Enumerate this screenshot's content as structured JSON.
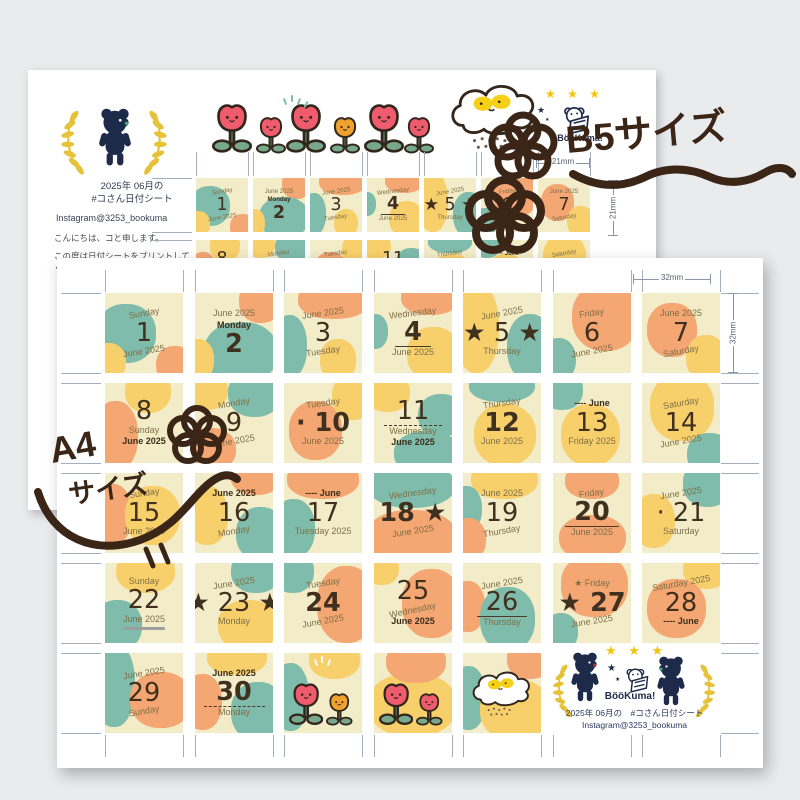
{
  "colors": {
    "background": "#eaebed",
    "sheet": "#ffffff",
    "teal": "#7fbcab",
    "yellow": "#f8d06b",
    "cream": "#f3ecc8",
    "orange": "#f4a673",
    "navy": "#1e2a4a",
    "star_yellow": "#f2c40f",
    "tulip_pink": "#ef5c6e",
    "tulip_orange": "#f0a22e",
    "leaf_green": "#79a98c",
    "laurel_yellow": "#e5c238",
    "handwriting_brown": "#3a2517",
    "text_dark": "#40301f",
    "text_olive": "#7d6f46",
    "tick_gray": "#a3aebe"
  },
  "b5_sheet": {
    "title_line1": "2025年 06月の",
    "title_line2": "#コさん日付シート",
    "instagram": "Instagram@3253_bookuma",
    "greeting": "こんにちは、コと申します。",
    "message_line1": "この度は日付シートをプリントして",
    "message_line2": "くださりありがとうございます。",
    "brand": "BööKuma!",
    "cell_size_label_h": "21mm",
    "cell_size_label_v": "21mm"
  },
  "a4_sheet": {
    "cell_size_label_h": "32mm",
    "cell_size_label_v": "32mm",
    "footer": {
      "brand": "BööKuma!",
      "line1": "2025年 06月の　#コさん日付シート",
      "line2": "Instagram@3253_bookuma"
    }
  },
  "annotations": {
    "b5_size_label": "B5サイズ",
    "a4_size_label_line1": "A4",
    "a4_size_label_line2": "サイズ"
  },
  "calendar": {
    "month": "June",
    "year": "2025",
    "cells": [
      {
        "n": 1,
        "lines": [
          {
            "t": "Sunday",
            "c": "m",
            "r": -10
          },
          {
            "t": "1",
            "c": "n"
          },
          {
            "t": "June 2025",
            "c": "m",
            "r": -9
          }
        ],
        "bl": [
          [
            "t",
            -12,
            14,
            78,
            74
          ],
          [
            "y",
            -18,
            62,
            45,
            48
          ],
          [
            "o",
            66,
            66,
            48,
            48
          ]
        ]
      },
      {
        "n": 2,
        "lines": [
          {
            "t": "June 2025",
            "c": "m"
          },
          {
            "t": "Monday",
            "c": "mb"
          },
          {
            "t": "2",
            "c": "nb"
          }
        ],
        "bl": [
          [
            "o",
            56,
            -16,
            56,
            54
          ],
          [
            "t",
            12,
            36,
            95,
            76
          ],
          [
            "y",
            -16,
            58,
            40,
            52
          ]
        ]
      },
      {
        "n": 3,
        "lines": [
          {
            "t": "June 2025",
            "c": "m",
            "r": -8
          },
          {
            "t": "3",
            "c": "n"
          },
          {
            "t": "Tuesday",
            "c": "m",
            "r": -8
          }
        ],
        "bl": [
          [
            "o",
            18,
            -16,
            92,
            48
          ],
          [
            "t",
            -16,
            28,
            46,
            78
          ],
          [
            "y",
            46,
            58,
            46,
            52
          ]
        ]
      },
      {
        "n": 4,
        "lines": [
          {
            "t": "Wednesday",
            "c": "m",
            "r": -7
          },
          {
            "t": "4",
            "c": "nb",
            "u": 1
          },
          {
            "t": "June 2025",
            "c": "m"
          }
        ],
        "bl": [
          [
            "o",
            34,
            -16,
            76,
            44
          ],
          [
            "t",
            -16,
            26,
            34,
            44
          ],
          [
            "y",
            42,
            42,
            68,
            68
          ]
        ]
      },
      {
        "n": 5,
        "lines": [
          {
            "t": "June 2025",
            "c": "m",
            "r": -10
          },
          {
            "t": "★ 5 ★",
            "c": "n"
          },
          {
            "t": "Thursday",
            "c": "m"
          }
        ],
        "bl": [
          [
            "y",
            -12,
            -12,
            58,
            112
          ],
          [
            "t",
            56,
            26,
            60,
            84
          ]
        ]
      },
      {
        "n": 6,
        "lines": [
          {
            "t": "Friday",
            "c": "m",
            "r": -8
          },
          {
            "t": "6",
            "c": "n"
          },
          {
            "t": "June 2025",
            "c": "m",
            "r": -10
          }
        ],
        "bl": [
          [
            "o",
            24,
            -12,
            86,
            84
          ],
          [
            "t",
            -16,
            56,
            46,
            54
          ]
        ]
      },
      {
        "n": 7,
        "lines": [
          {
            "t": "June 2025",
            "c": "m"
          },
          {
            "t": "7",
            "c": "n"
          },
          {
            "t": "Saturday",
            "c": "m",
            "r": -10
          }
        ],
        "bl": [
          [
            "o",
            6,
            12,
            64,
            68
          ],
          [
            "y",
            56,
            52,
            52,
            58
          ]
        ]
      },
      {
        "n": 8,
        "lines": [
          {
            "t": "8",
            "c": "n"
          },
          {
            "t": "Sunday",
            "c": "m"
          },
          {
            "t": "June 2025",
            "c": "mb"
          }
        ],
        "bl": [
          [
            "y",
            26,
            -16,
            58,
            54
          ],
          [
            "o",
            -16,
            22,
            58,
            88
          ]
        ]
      },
      {
        "n": 9,
        "lines": [
          {
            "t": "Monday",
            "c": "m",
            "r": -10
          },
          {
            "t": "9",
            "c": "n"
          },
          {
            "t": "June 2025",
            "c": "m",
            "r": -10
          }
        ],
        "bl": [
          [
            "y",
            -12,
            -16,
            54,
            50
          ],
          [
            "t",
            42,
            -16,
            68,
            58
          ],
          [
            "o",
            -12,
            56,
            64,
            54
          ]
        ]
      },
      {
        "n": 10,
        "lines": [
          {
            "t": "Tuesday",
            "c": "m",
            "r": -8
          },
          {
            "t": "· 10",
            "c": "nb"
          },
          {
            "t": "June 2025",
            "c": "m"
          }
        ],
        "bl": [
          [
            "o",
            6,
            22,
            68,
            74
          ],
          [
            "y",
            62,
            -12,
            54,
            58
          ]
        ]
      },
      {
        "n": 11,
        "lines": [
          {
            "t": "11",
            "c": "n",
            "d": 1
          },
          {
            "t": "Wednesday",
            "c": "m"
          },
          {
            "t": "June 2025",
            "c": "mb"
          }
        ],
        "bl": [
          [
            "y",
            -12,
            -12,
            58,
            48
          ],
          [
            "t",
            56,
            14,
            60,
            54
          ],
          [
            "t",
            26,
            60,
            84,
            56
          ]
        ]
      },
      {
        "n": 12,
        "lines": [
          {
            "t": "Thursday",
            "c": "m",
            "r": -8
          },
          {
            "t": "12",
            "c": "nb"
          },
          {
            "t": "June 2025",
            "c": "m"
          }
        ],
        "bl": [
          [
            "t",
            8,
            -16,
            84,
            40
          ],
          [
            "y",
            14,
            26,
            80,
            78
          ]
        ]
      },
      {
        "n": 13,
        "lines": [
          {
            "t": "---- June",
            "c": "mb"
          },
          {
            "t": "13",
            "c": "n"
          },
          {
            "t": "Friday 2025",
            "c": "m"
          }
        ],
        "bl": [
          [
            "t",
            -16,
            -16,
            54,
            50
          ],
          [
            "y",
            10,
            26,
            76,
            78
          ]
        ]
      },
      {
        "n": 14,
        "lines": [
          {
            "t": "Saturday",
            "c": "m",
            "r": -10
          },
          {
            "t": "14",
            "c": "n"
          },
          {
            "t": "June 2025",
            "c": "m",
            "r": -10
          }
        ],
        "bl": [
          [
            "y",
            10,
            -12,
            82,
            84
          ],
          [
            "t",
            58,
            62,
            58,
            54
          ]
        ]
      },
      {
        "n": 15,
        "lines": [
          {
            "t": "Sunday",
            "c": "m",
            "r": -8
          },
          {
            "t": "15",
            "c": "n"
          },
          {
            "t": "June 2025",
            "c": "m"
          }
        ],
        "bl": [
          [
            "o",
            -16,
            14,
            50,
            76
          ],
          [
            "y",
            26,
            16,
            70,
            74
          ]
        ]
      },
      {
        "n": 16,
        "lines": [
          {
            "t": "June 2025",
            "c": "mb"
          },
          {
            "t": "16",
            "c": "n"
          },
          {
            "t": "Monday",
            "c": "m",
            "r": -10
          }
        ],
        "bl": [
          [
            "y",
            -12,
            16,
            54,
            74
          ],
          [
            "o",
            46,
            -16,
            64,
            44
          ],
          [
            "t",
            52,
            42,
            64,
            68
          ]
        ]
      },
      {
        "n": 17,
        "lines": [
          {
            "t": "---- June",
            "c": "mb"
          },
          {
            "t": "17",
            "c": "n"
          },
          {
            "t": "Tuesday 2025",
            "c": "m"
          }
        ],
        "bl": [
          [
            "o",
            4,
            -16,
            92,
            48
          ],
          [
            "t",
            -16,
            32,
            56,
            74
          ]
        ]
      },
      {
        "n": 18,
        "lines": [
          {
            "t": "Wednesday",
            "c": "m",
            "r": -8
          },
          {
            "t": "18 ★",
            "c": "nb"
          },
          {
            "t": "June 2025",
            "c": "m",
            "r": -9
          }
        ],
        "bl": [
          [
            "t",
            -8,
            -12,
            112,
            56
          ],
          [
            "o",
            -10,
            46,
            116,
            68
          ]
        ]
      },
      {
        "n": 19,
        "lines": [
          {
            "t": "June 2025",
            "c": "m"
          },
          {
            "t": "19",
            "c": "n"
          },
          {
            "t": "Thursday",
            "c": "m",
            "r": -10
          }
        ],
        "bl": [
          [
            "y",
            10,
            -16,
            86,
            48
          ],
          [
            "t",
            -16,
            16,
            40,
            58
          ],
          [
            "o",
            -16,
            56,
            46,
            54
          ]
        ]
      },
      {
        "n": 20,
        "lines": [
          {
            "t": "Friday",
            "c": "m",
            "r": -7
          },
          {
            "t": "20",
            "c": "nb",
            "u": 1
          },
          {
            "t": "June 2025",
            "c": "m"
          }
        ],
        "bl": [
          [
            "o",
            16,
            -12,
            68,
            44
          ],
          [
            "o",
            8,
            52,
            86,
            58
          ]
        ]
      },
      {
        "n": 21,
        "lines": [
          {
            "t": "June 2025",
            "c": "m",
            "r": -9
          },
          {
            "t": "· 21",
            "c": "n"
          },
          {
            "t": "Saturday",
            "c": "m"
          }
        ],
        "bl": [
          [
            "t",
            52,
            -16,
            64,
            58
          ],
          [
            "y",
            -12,
            26,
            54,
            68
          ]
        ]
      },
      {
        "n": 22,
        "lines": [
          {
            "t": "Sunday",
            "c": "m"
          },
          {
            "t": "22",
            "c": "n"
          },
          {
            "t": "June 2025",
            "c": "m",
            "g": 1
          }
        ],
        "bl": [
          [
            "y",
            14,
            -16,
            76,
            54
          ],
          [
            "t",
            -16,
            46,
            64,
            64
          ]
        ]
      },
      {
        "n": 23,
        "lines": [
          {
            "t": "June 2025",
            "c": "m",
            "r": -9
          },
          {
            "t": "★ 23 ★",
            "c": "n"
          },
          {
            "t": "Monday",
            "c": "m"
          }
        ],
        "bl": [
          [
            "t",
            46,
            -16,
            64,
            54
          ],
          [
            "y",
            30,
            46,
            76,
            64
          ]
        ]
      },
      {
        "n": 24,
        "lines": [
          {
            "t": "Tuesday",
            "c": "m",
            "r": -9
          },
          {
            "t": "24",
            "c": "nb"
          },
          {
            "t": "June 2025",
            "c": "m",
            "r": -10
          }
        ],
        "bl": [
          [
            "t",
            -16,
            -16,
            54,
            54
          ],
          [
            "o",
            42,
            4,
            76,
            96
          ]
        ]
      },
      {
        "n": 25,
        "lines": [
          {
            "t": "25",
            "c": "n"
          },
          {
            "t": "Wednesday",
            "c": "m",
            "r": -12
          },
          {
            "t": "June 2025",
            "c": "mb"
          }
        ],
        "bl": [
          [
            "y",
            -12,
            -12,
            44,
            40
          ],
          [
            "o",
            36,
            8,
            76,
            86
          ]
        ]
      },
      {
        "n": 26,
        "lines": [
          {
            "t": "June 2025",
            "c": "m",
            "r": -9
          },
          {
            "t": "26",
            "c": "n",
            "u": 1
          },
          {
            "t": "Thursday",
            "c": "m"
          }
        ],
        "bl": [
          [
            "o",
            -16,
            22,
            44,
            64
          ],
          [
            "t",
            22,
            30,
            70,
            80
          ]
        ]
      },
      {
        "n": 27,
        "lines": [
          {
            "t": "★ Friday",
            "c": "m"
          },
          {
            "t": "★ 27",
            "c": "nb"
          },
          {
            "t": "June 2025",
            "c": "m",
            "r": -9
          }
        ],
        "bl": [
          [
            "o",
            10,
            -12,
            86,
            80
          ],
          [
            "t",
            -12,
            62,
            44,
            48
          ]
        ]
      },
      {
        "n": 28,
        "lines": [
          {
            "t": "Saturday 2025",
            "c": "m",
            "r": -10
          },
          {
            "t": "28",
            "c": "n"
          },
          {
            "t": "---- June",
            "c": "mb"
          }
        ],
        "bl": [
          [
            "y",
            52,
            -16,
            60,
            48
          ],
          [
            "o",
            6,
            20,
            76,
            74
          ]
        ]
      },
      {
        "n": 29,
        "lines": [
          {
            "t": "June 2025",
            "c": "m",
            "r": -9
          },
          {
            "t": "29",
            "c": "n"
          },
          {
            "t": "Sunday",
            "c": "m",
            "r": -10
          }
        ],
        "bl": [
          [
            "t",
            -16,
            -12,
            54,
            104
          ],
          [
            "o",
            32,
            24,
            80,
            70
          ]
        ]
      },
      {
        "n": 30,
        "lines": [
          {
            "t": "June 2025",
            "c": "mb"
          },
          {
            "t": "30",
            "c": "nb",
            "d": 1
          },
          {
            "t": "Monday",
            "c": "m"
          }
        ],
        "bl": [
          [
            "y",
            16,
            -16,
            76,
            44
          ],
          [
            "o",
            -16,
            26,
            50,
            70
          ],
          [
            "t",
            46,
            36,
            70,
            74
          ]
        ]
      }
    ],
    "decor": {
      "tulipsA": {
        "bl": [
          [
            "t",
            -16,
            12,
            48,
            86
          ],
          [
            "y",
            32,
            -16,
            66,
            48
          ]
        ],
        "tulips": [
          "pink",
          "orange"
        ]
      },
      "tulipsB": {
        "bl": [
          [
            "y",
            -8,
            25,
            115,
            80
          ],
          [
            "o",
            16,
            -16,
            76,
            54
          ]
        ],
        "tulips": [
          "pink",
          "pink"
        ]
      },
      "cloud": {
        "bl": [
          [
            "t",
            -16,
            16,
            46,
            80
          ],
          [
            "o",
            56,
            -16,
            60,
            48
          ],
          [
            "y",
            22,
            32,
            90,
            78
          ]
        ]
      }
    },
    "b5_top_tulips": [
      "pink-big",
      "pink-small",
      "pink-big",
      "orange-small",
      "pink-big",
      "pink-small"
    ]
  }
}
